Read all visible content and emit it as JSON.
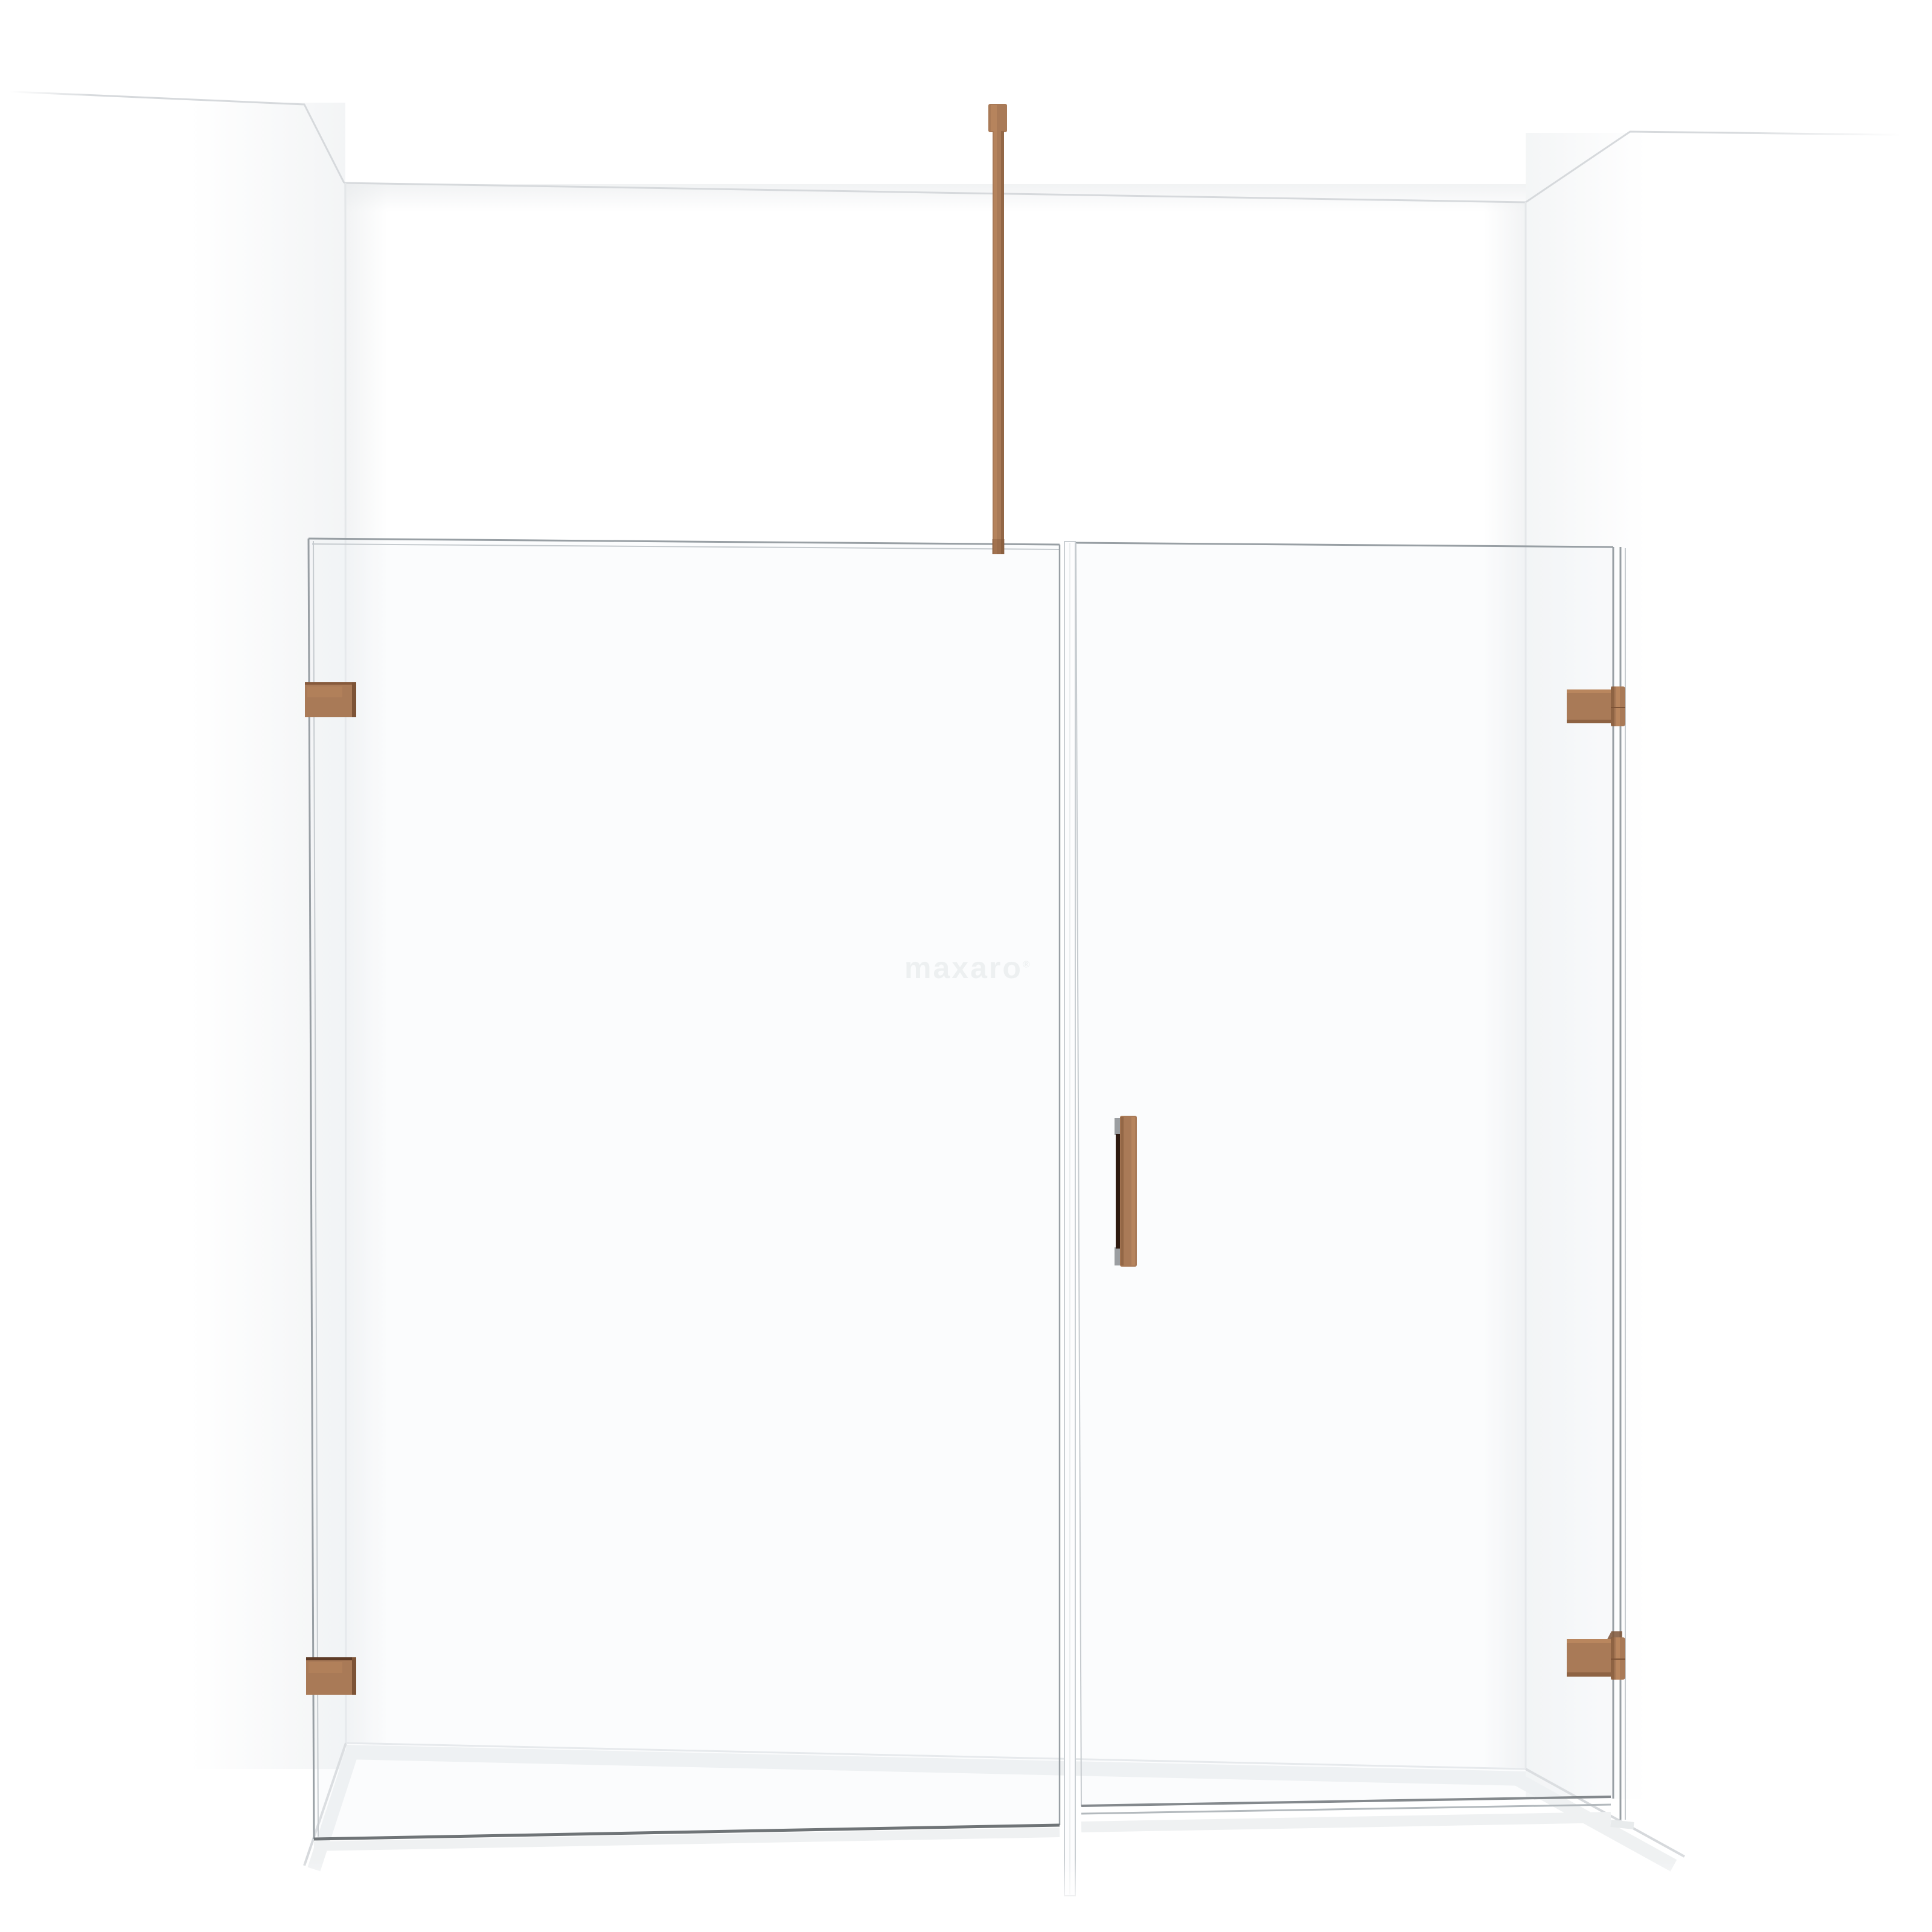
{
  "watermark": {
    "text": "maxaro",
    "registered_mark": "®"
  },
  "theme": {
    "background": "#ffffff",
    "wall_line": "#d6d9dc",
    "wall_line_soft": "#e4e7e9",
    "floor_shadow": "#eff1f2",
    "glass_line": "#989fa4",
    "glass_line_light": "#c6cbcf",
    "glass_edge_dark": "#6f7477",
    "glass_fill": "rgba(238,242,244,0.22)",
    "copper": "#a97a57",
    "copper_light": "#c08b61",
    "copper_dark": "#7d5336",
    "copper_deep": "#5e3b26",
    "handle_recess": "#2e1a10",
    "cap_gray": "#9b9ea1",
    "profile_white": "#fdfdfe",
    "profile_line": "#c9ced2",
    "watermark": "#edf0f1"
  }
}
